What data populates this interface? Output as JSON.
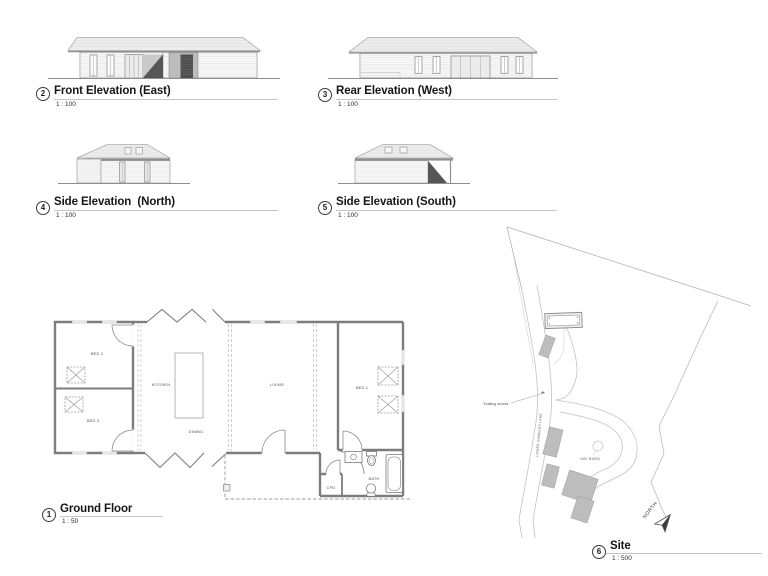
{
  "sheet": {
    "background": "#ffffff"
  },
  "views": {
    "front": {
      "number": "2",
      "title": "Front Elevation (East)",
      "scale": "1 : 100"
    },
    "rear": {
      "number": "3",
      "title": "Rear Elevation (West)",
      "scale": "1 : 100"
    },
    "side_north": {
      "number": "4",
      "title": "Side Elevation  (North)",
      "scale": "1 : 100"
    },
    "side_south": {
      "number": "5",
      "title": "Side Elevation (South)",
      "scale": "1 : 100"
    },
    "ground_floor": {
      "number": "1",
      "title": "Ground Floor",
      "scale": "1 : 50"
    },
    "site": {
      "number": "6",
      "title": "Site",
      "scale": "1 : 500"
    }
  },
  "floor_plan": {
    "rooms": {
      "bed2": "BED 2",
      "bed3": "BED 3",
      "kitchen": "KITCHEN",
      "dining": "DINING",
      "living": "LIVING",
      "bed1": "BED 1",
      "bath": "BATH",
      "cpd": "CPD"
    }
  },
  "site_plan": {
    "existing_access": "Existing access",
    "lane": "LOWER GAMBLES LANE",
    "hay_barn": "HAY BARN",
    "north": "NORTH"
  },
  "colors": {
    "linework": "#8f8f8f",
    "dark_shading": "#565656",
    "existing_building_fill": "#bdbdbd",
    "roof_fill": "#ededed"
  }
}
